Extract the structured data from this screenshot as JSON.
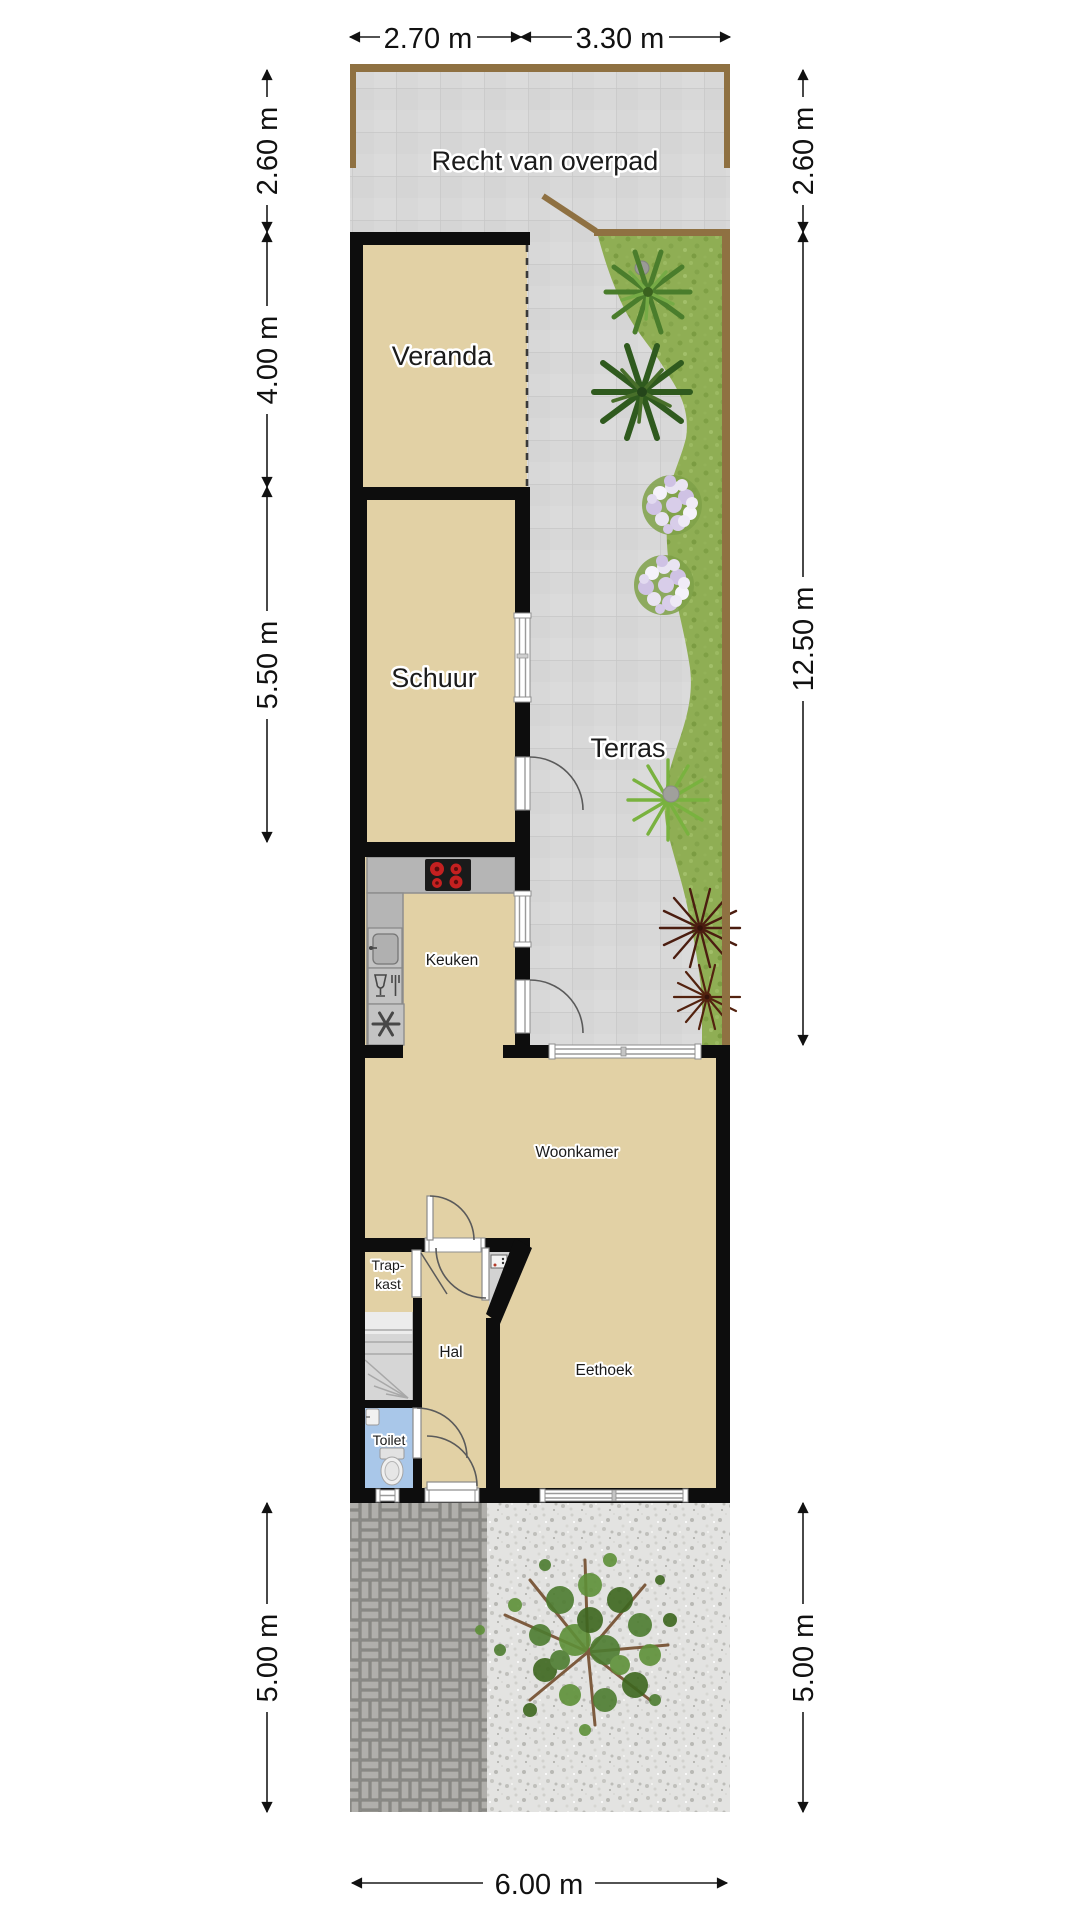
{
  "areas": {
    "overpad": "Recht van overpad",
    "veranda": "Veranda",
    "schuur": "Schuur",
    "terras": "Terras",
    "keuken": "Keuken",
    "woonkamer": "Woonkamer",
    "trapkast_line1": "Trap-",
    "trapkast_line2": "kast",
    "hal": "Hal",
    "eethoek": "Eethoek",
    "toilet": "Toilet"
  },
  "dimensions": {
    "top": [
      "2.70 m",
      "3.30 m"
    ],
    "left": [
      "2.60 m",
      "4.00 m",
      "5.50 m",
      "5.00 m"
    ],
    "right": [
      "2.60 m",
      "12.50 m",
      "5.00 m"
    ],
    "bottom": "6.00 m"
  },
  "fixtures": {
    "stove": "stove-burners-icon",
    "sink": "kitchen-sink-icon",
    "dishwasher": "dishwasher-icon",
    "extractor": "extractor-fan-icon",
    "toilet": "toilet-bowl-icon",
    "hand_basin": "hand-basin-icon",
    "meter_panel": "meter-cupboard-panel-icon",
    "stairs": "staircase-icon",
    "tree": "tree-icon",
    "palm": "palm-plant-icon",
    "flowers": "flower-bed-icon",
    "dark_grass": "ornamental-grass-icon"
  },
  "colors": {
    "floor_tan": "#e2d1a5",
    "wall_black": "#0d0d0d",
    "tile_gray": "#d8d8d8",
    "grass_green": "#8fae54",
    "fence_brown": "#8f7142",
    "toilet_blue": "#a9c7e9",
    "counter_gray": "#b5b5b5",
    "burner_red": "#c42020"
  }
}
